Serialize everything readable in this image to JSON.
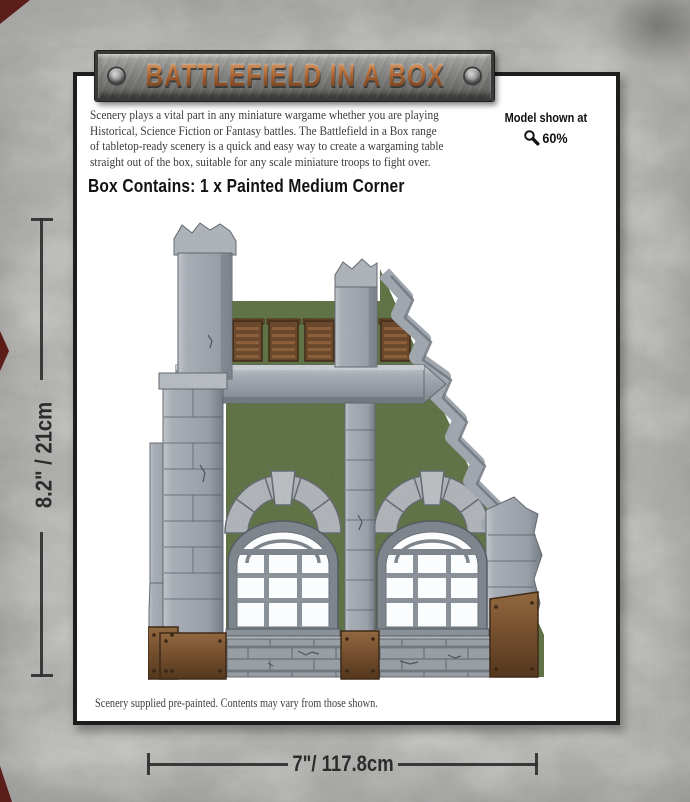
{
  "banner": {
    "title": "BATTLEFIELD IN A BOX"
  },
  "intro": {
    "line1": "Scenery plays a vital part in any miniature wargame whether you are playing",
    "line2": "Historical, Science Fiction or Fantasy battles. The Battlefield in a Box range",
    "line3": "of tabletop-ready scenery is a quick and easy way to create a wargaming table",
    "line4": "straight out of the box, suitable for any scale miniature troops to fight over."
  },
  "scale_note": {
    "label": "Model shown at",
    "icon": "magnifier-icon",
    "value": "60%"
  },
  "contents": {
    "heading": "Box Contains: 1 x Painted Medium Corner"
  },
  "footnote": "Scenery supplied pre-painted. Contents may vary from those shown.",
  "dimensions": {
    "height_label": "8.2\" / 21cm",
    "width_label": "7\"/ 117.8cm"
  },
  "product_colors": {
    "stone_grey": "#a0a6ad",
    "moss_green": "#5d6e44",
    "rust_brown": "#77512f",
    "vent_brown": "#6a482c",
    "window_white": "#fbfcfd"
  },
  "theme": {
    "background_concrete": "#b4b4b2",
    "panel_white": "#ffffff",
    "ink_black": "#1d1d1b",
    "accent_red": "#5f1712",
    "banner_copper": "#9e5c2f"
  }
}
